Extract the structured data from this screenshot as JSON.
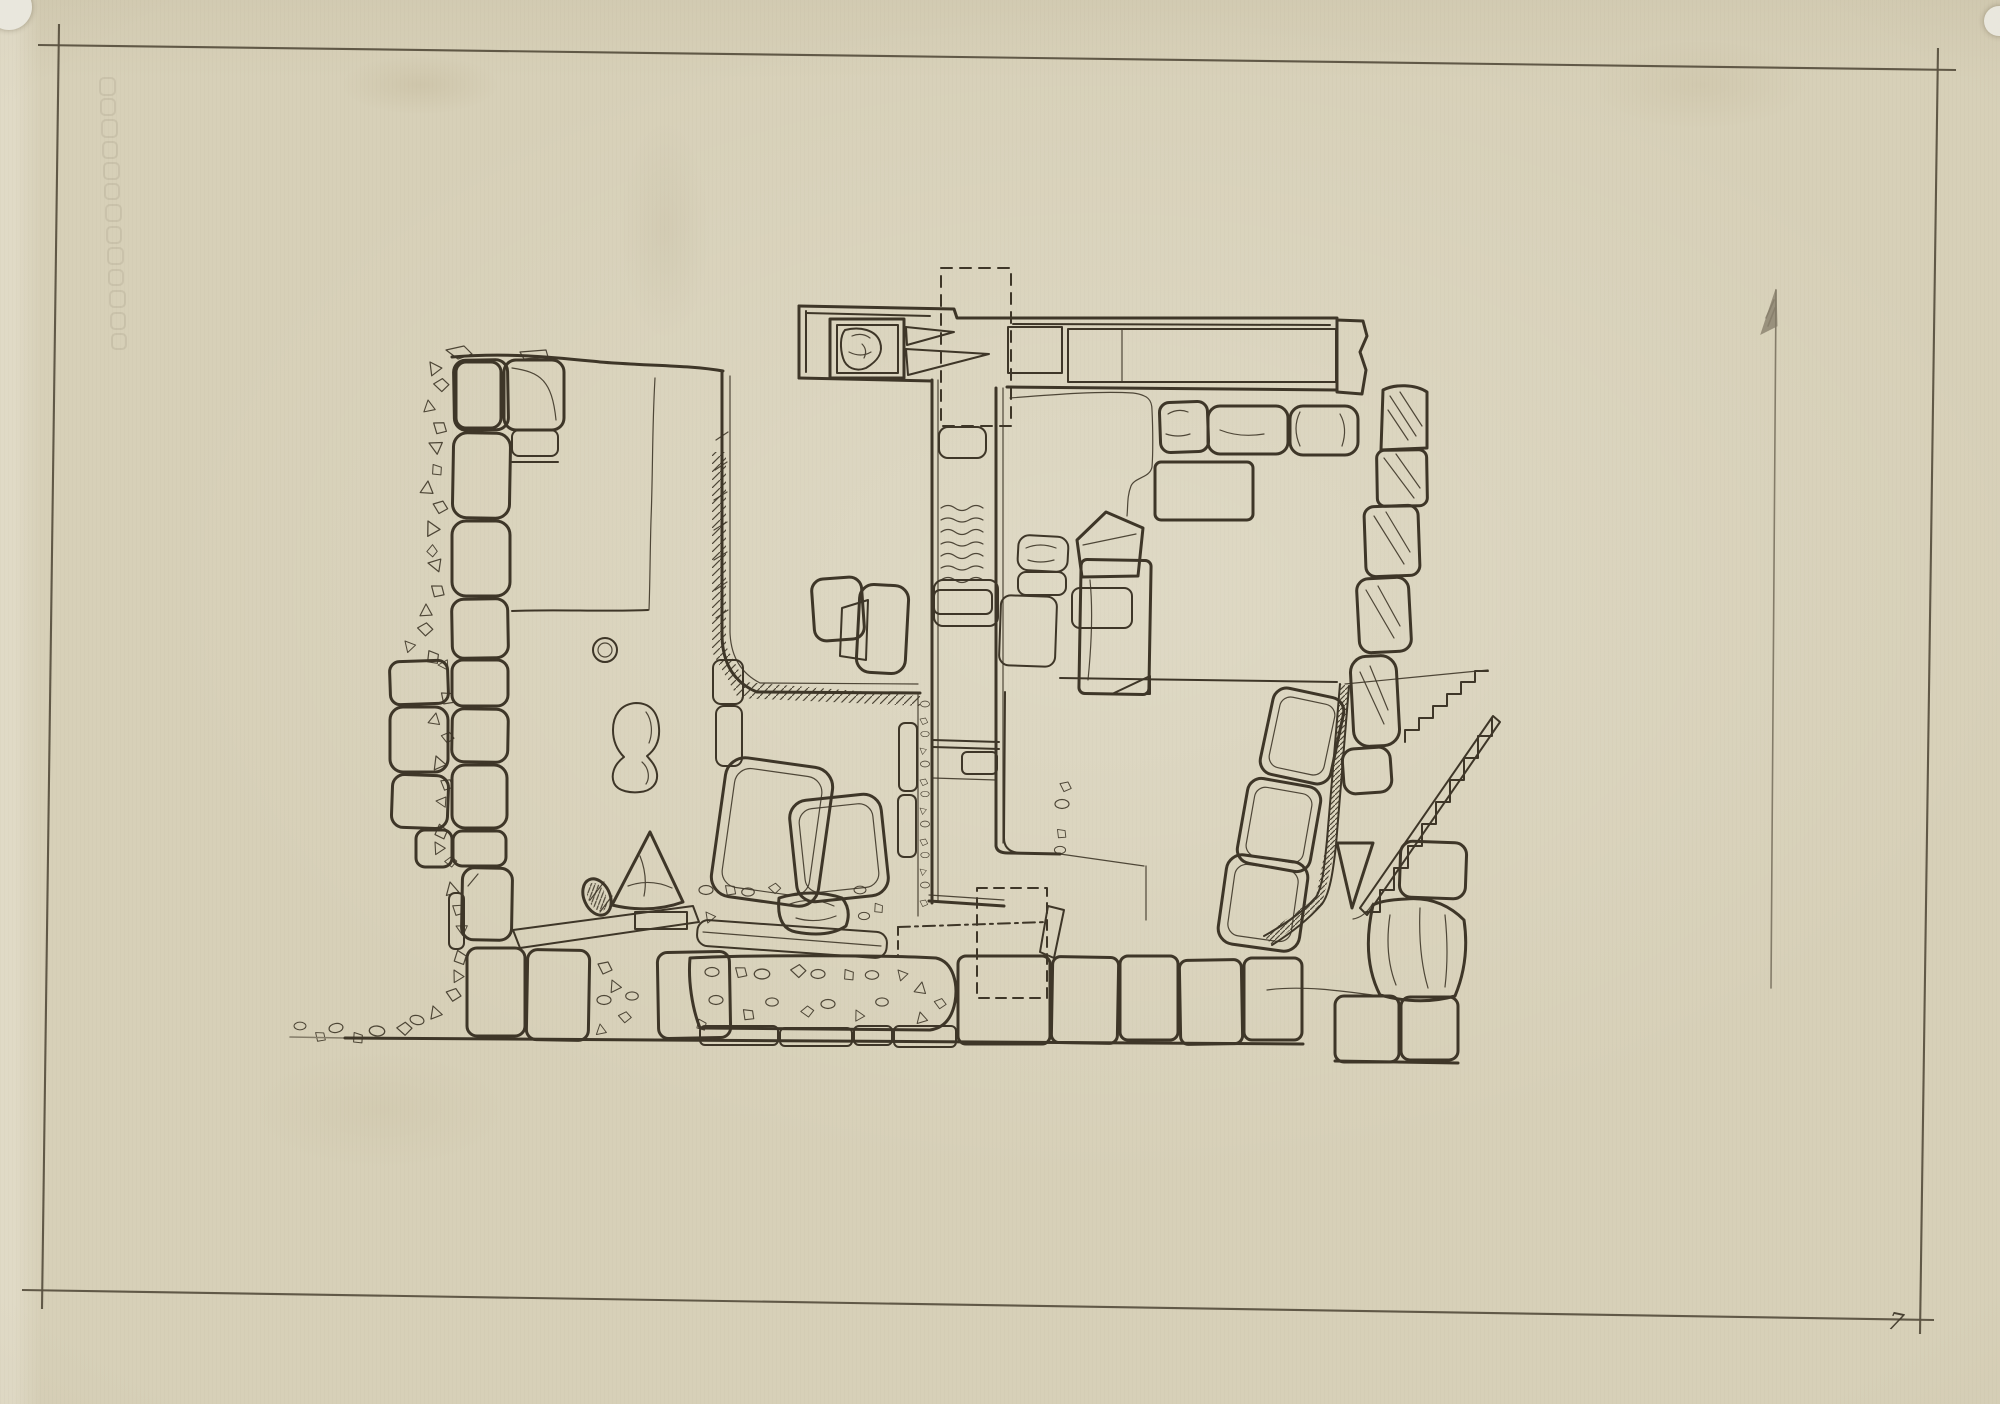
{
  "page": {
    "kind": "scanned hand-drawn archaeological excavation plan on aged tracing paper",
    "page_mark": "7"
  },
  "theme": {
    "paper": "#d7d0b8",
    "paper-light": "#ded8c3",
    "paper-dark": "#c6bfa4",
    "ink": "#3e3628",
    "ink-soft": "#5a5140",
    "pencil": "#847c69",
    "white-spot": "#e9e7dd"
  },
  "north_arrow": {
    "icon": "north-arrow",
    "direction": "up"
  },
  "watermark": {
    "legible": false,
    "description": "faint embossed vertical mark along left edge"
  }
}
